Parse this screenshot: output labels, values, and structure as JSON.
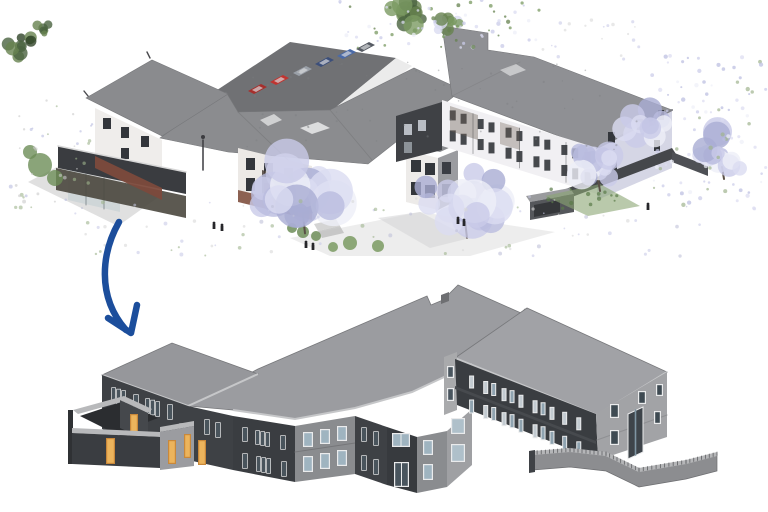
{
  "figure": {
    "title": "Scan-to-BIM conversion figure",
    "background": "#ffffff",
    "views": [
      {
        "id": "point-cloud-view",
        "label": "Photorealistic laser-scan point cloud of a two-storey care home with parking, trees and people",
        "type": "point-cloud",
        "position": "top"
      },
      {
        "id": "bim-model-view",
        "label": "Reconstructed grey BIM model of the same building with courtyard and curved boundary wall",
        "type": "bim-model",
        "position": "bottom"
      }
    ]
  },
  "arrow": {
    "name": "scan-to-bim-arrow",
    "color": "#1C4E9C",
    "style": "thick curved stroke with open barbed head",
    "from": "point-cloud-view",
    "to": "bim-model-view"
  },
  "point_cloud": {
    "building_floors": 2,
    "roof_color": "#8B8C8F",
    "roof_right_color": "#8F9094",
    "wall_white": "#EFEDEB",
    "wall_white_right": "#F1F0F3",
    "gable_lavender": "#D5D6E5",
    "brick_color": "#7C4A3C",
    "dark_wall": "#3A3C40",
    "asphalt": "#707174",
    "sidewalk": "#E9E9E9",
    "window_dark": "#33363B",
    "fence_dark": "#45474B",
    "tree_palette": [
      "#C9CBE8",
      "#DBDCF1",
      "#B9BCDF",
      "#EEEFF8",
      "#A9ADD3"
    ],
    "green_palette": [
      "#66824F",
      "#4A6340",
      "#7A9A62",
      "#6D8D58"
    ],
    "cars": [
      {
        "color": "#A62F2C"
      },
      {
        "color": "#C03430"
      },
      {
        "color": "#9AA0A8"
      },
      {
        "color": "#3C4F7A"
      },
      {
        "color": "#4A6AA8"
      },
      {
        "color": "#565B63"
      }
    ],
    "lavender_tree_count": 5,
    "green_tree_count": 4,
    "people_count": 7
  },
  "bim": {
    "floors": 2,
    "roof_color": "#9B9CA0",
    "roof_right_color": "#A1A2A6",
    "roof_left_color": "#96979B",
    "fascia_color": "#C6C7C9",
    "wall_dark": "#3A3D41",
    "wall_dark_alt": "#3E4145",
    "wall_darker": "#373A3E",
    "wall_mid": "#8A8C8F",
    "wall_light": "#A2A3A6",
    "wall_cant": "#9FA0A3",
    "wall_inner": "#A9AAAC",
    "cap_color": "#B8B9BB",
    "window_frame": "#EAEBEC",
    "window_glass": "#9FB4C0",
    "window_glass_dark": "#49555E",
    "door_color": "#D9973F",
    "door_color_light": "#ECB45C",
    "entrance_color": "#3E444A",
    "courtyard_floor": "#2B2D30",
    "curved_wall_face": "#8C8D90",
    "curved_wall_cap": "#B5B6B8",
    "has_courtyard": true,
    "has_curved_boundary_wall": true
  }
}
